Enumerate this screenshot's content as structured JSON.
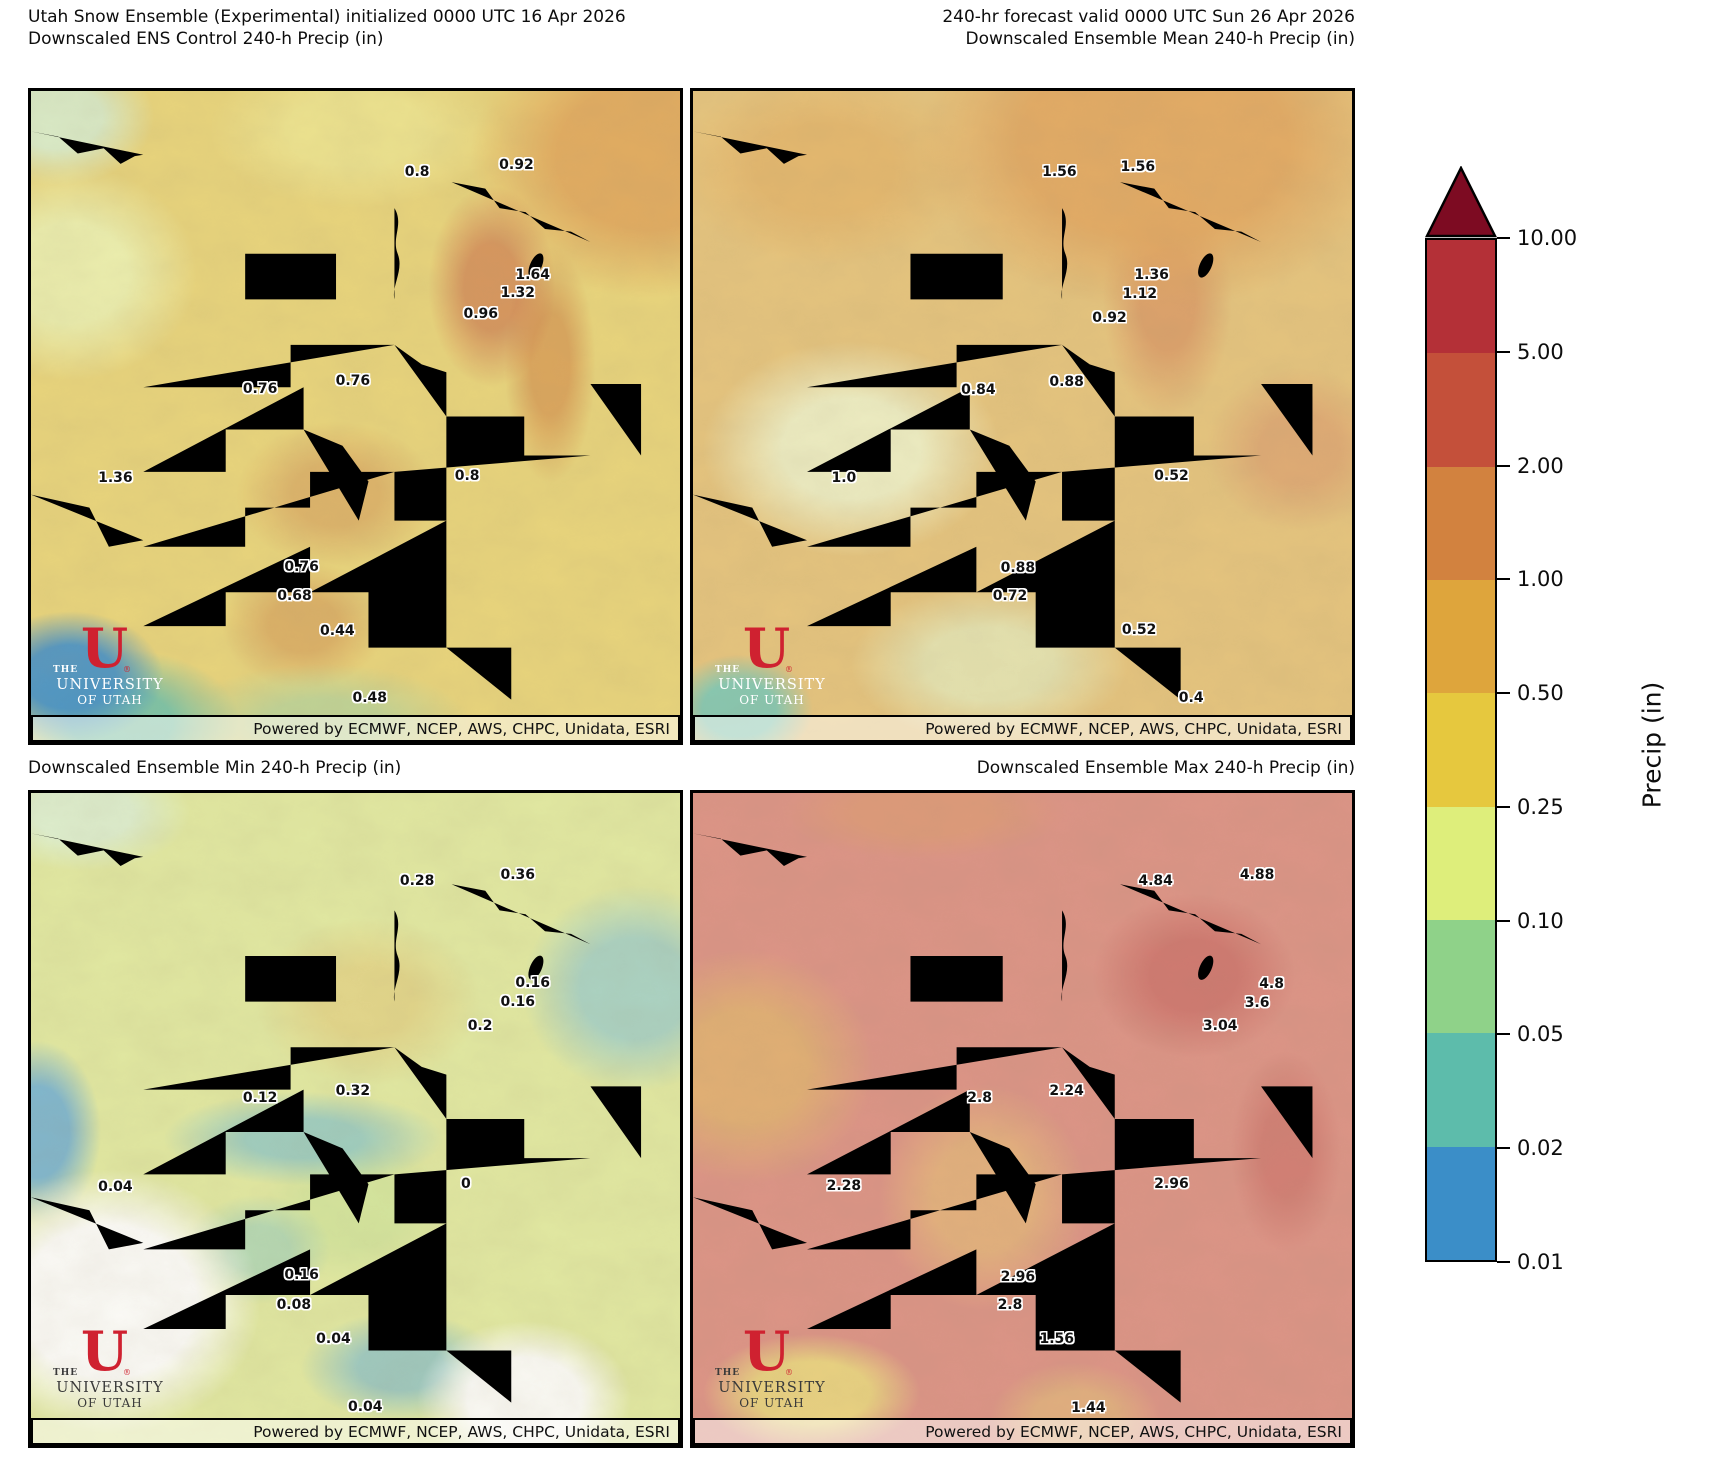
{
  "figure": {
    "top_left_title": "Utah Snow Ensemble (Experimental) initialized 0000 UTC 16 Apr 2026\nDownscaled ENS Control 240-h Precip (in)",
    "top_right_title": "240-hr forecast valid 0000 UTC Sun 26 Apr 2026\nDownscaled Ensemble Mean 240-h Precip (in)",
    "bottom_left_title": "Downscaled Ensemble Min 240-h Precip (in)",
    "bottom_right_title": "Downscaled Ensemble Max 240-h Precip (in)",
    "credit": "Powered by ECMWF, NCEP, AWS, CHPC, Unidata, ESRI"
  },
  "logo": {
    "the": "THE",
    "u": "U",
    "registered": "®",
    "university": "UNIVERSITY",
    "of_utah": "OF UTAH"
  },
  "colorbar": {
    "title": "Precip (in)",
    "tick_labels": [
      "10.00",
      "5.00",
      "2.00",
      "1.00",
      "0.50",
      "0.25",
      "0.10",
      "0.05",
      "0.02",
      "0.01"
    ],
    "segment_colors_top_to_bottom": [
      "#b43037",
      "#c4503a",
      "#d2823f",
      "#dea53c",
      "#e6c83e",
      "#deee7b",
      "#8fd289",
      "#5dbcab",
      "#3b8ec8"
    ],
    "arrow_color": "#7d0b22"
  },
  "panels": [
    {
      "name": "Downscaled ENS Control 240-h Precip (in)",
      "labels": [
        {
          "v": "0.8",
          "x": 59.5,
          "y": 12.5
        },
        {
          "v": "0.92",
          "x": 74.8,
          "y": 11.4
        },
        {
          "v": "1.64",
          "x": 77.3,
          "y": 28.2
        },
        {
          "v": "1.32",
          "x": 75.0,
          "y": 31.1
        },
        {
          "v": "0.96",
          "x": 69.3,
          "y": 34.2
        },
        {
          "v": "0.76",
          "x": 35.3,
          "y": 45.8
        },
        {
          "v": "0.76",
          "x": 49.6,
          "y": 44.6
        },
        {
          "v": "1.36",
          "x": 13.0,
          "y": 59.5
        },
        {
          "v": "0.8",
          "x": 67.2,
          "y": 59.1
        },
        {
          "v": "0.76",
          "x": 41.7,
          "y": 73.1
        },
        {
          "v": "0.68",
          "x": 40.6,
          "y": 77.6
        },
        {
          "v": "0.44",
          "x": 47.2,
          "y": 82.9
        },
        {
          "v": "0.48",
          "x": 52.2,
          "y": 93.3
        }
      ]
    },
    {
      "name": "Downscaled Ensemble Mean 240-h Precip (in)",
      "labels": [
        {
          "v": "1.56",
          "x": 55.6,
          "y": 12.5
        },
        {
          "v": "1.56",
          "x": 67.5,
          "y": 11.7
        },
        {
          "v": "1.36",
          "x": 69.6,
          "y": 28.3
        },
        {
          "v": "1.12",
          "x": 67.8,
          "y": 31.2
        },
        {
          "v": "0.92",
          "x": 63.2,
          "y": 34.9
        },
        {
          "v": "0.84",
          "x": 43.3,
          "y": 46.0
        },
        {
          "v": "0.88",
          "x": 56.7,
          "y": 44.7
        },
        {
          "v": "1.0",
          "x": 22.9,
          "y": 59.5
        },
        {
          "v": "0.52",
          "x": 72.6,
          "y": 59.1
        },
        {
          "v": "0.88",
          "x": 49.3,
          "y": 73.2
        },
        {
          "v": "0.72",
          "x": 48.1,
          "y": 77.6
        },
        {
          "v": "0.52",
          "x": 67.7,
          "y": 82.8
        },
        {
          "v": "0.4",
          "x": 75.6,
          "y": 93.3
        }
      ]
    },
    {
      "name": "Downscaled Ensemble Min 240-h Precip (in)",
      "labels": [
        {
          "v": "0.28",
          "x": 59.5,
          "y": 13.5
        },
        {
          "v": "0.36",
          "x": 75.0,
          "y": 12.6
        },
        {
          "v": "0.16",
          "x": 77.3,
          "y": 29.2
        },
        {
          "v": "0.16",
          "x": 75.0,
          "y": 32.1
        },
        {
          "v": "0.2",
          "x": 69.2,
          "y": 35.7
        },
        {
          "v": "0.12",
          "x": 35.3,
          "y": 46.8
        },
        {
          "v": "0.32",
          "x": 49.6,
          "y": 45.7
        },
        {
          "v": "0.04",
          "x": 13.0,
          "y": 60.5
        },
        {
          "v": "0",
          "x": 67.0,
          "y": 59.9
        },
        {
          "v": "0.16",
          "x": 41.7,
          "y": 74.0
        },
        {
          "v": "0.08",
          "x": 40.5,
          "y": 78.6
        },
        {
          "v": "0.04",
          "x": 46.6,
          "y": 83.7
        },
        {
          "v": "0.04",
          "x": 51.5,
          "y": 94.1
        }
      ]
    },
    {
      "name": "Downscaled Ensemble Max 240-h Precip (in)",
      "labels": [
        {
          "v": "4.84",
          "x": 70.2,
          "y": 13.5
        },
        {
          "v": "4.88",
          "x": 85.6,
          "y": 12.6
        },
        {
          "v": "4.8",
          "x": 87.8,
          "y": 29.3
        },
        {
          "v": "3.6",
          "x": 85.6,
          "y": 32.2
        },
        {
          "v": "3.04",
          "x": 80.0,
          "y": 35.7
        },
        {
          "v": "2.8",
          "x": 43.5,
          "y": 46.8
        },
        {
          "v": "2.24",
          "x": 56.7,
          "y": 45.7
        },
        {
          "v": "2.28",
          "x": 22.9,
          "y": 60.3
        },
        {
          "v": "2.96",
          "x": 72.6,
          "y": 59.9
        },
        {
          "v": "2.96",
          "x": 49.3,
          "y": 74.2
        },
        {
          "v": "2.8",
          "x": 48.1,
          "y": 78.6
        },
        {
          "v": "1.56",
          "x": 55.2,
          "y": 83.7
        },
        {
          "v": "1.44",
          "x": 60.0,
          "y": 94.4
        }
      ]
    }
  ]
}
